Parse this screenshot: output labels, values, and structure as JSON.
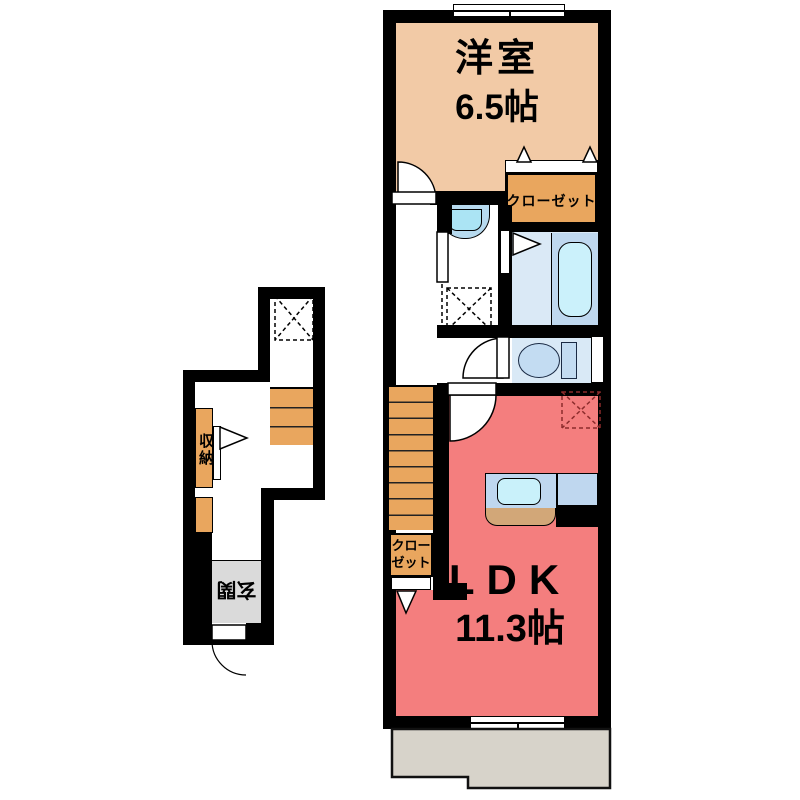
{
  "floor_plan": {
    "unit_2f": {
      "western_room": {
        "name": "洋室",
        "size": "6.5帖"
      },
      "closet_upper": {
        "name": "クローゼット"
      },
      "closet_ldk": {
        "line1": "クロー",
        "line2": "ゼット"
      },
      "ldk": {
        "name": "LDK",
        "size": "11.3帖"
      },
      "balcony": {
        "name": "バルコニー"
      }
    },
    "entrance_1f": {
      "storage": {
        "name": "収納"
      },
      "entrance": {
        "name": "玄関"
      }
    },
    "fixtures": [
      "bathtub",
      "washbasin",
      "toilet",
      "kitchen-sink",
      "staircase-2f",
      "staircase-1f",
      "washer-pan",
      "fridge-space"
    ],
    "colors": {
      "wall": "#000000",
      "western_room": "#F2CAA6",
      "closet_orange": "#E9A65E",
      "ldk_pink": "#F47E7E",
      "bath_bg": "#DAE9F6",
      "tub_panel": "#BFD8EF",
      "tub": "#CBF1FB",
      "counter": "#BFD7EF",
      "sink": "#C9F1FA",
      "counter_front": "#D2A778",
      "toilet_fixture": "#C3DCF2",
      "balcony_gray": "#D7D3CA",
      "entrance_gray": "#DADADA",
      "fridge_dash": "#8B2B2B"
    }
  }
}
